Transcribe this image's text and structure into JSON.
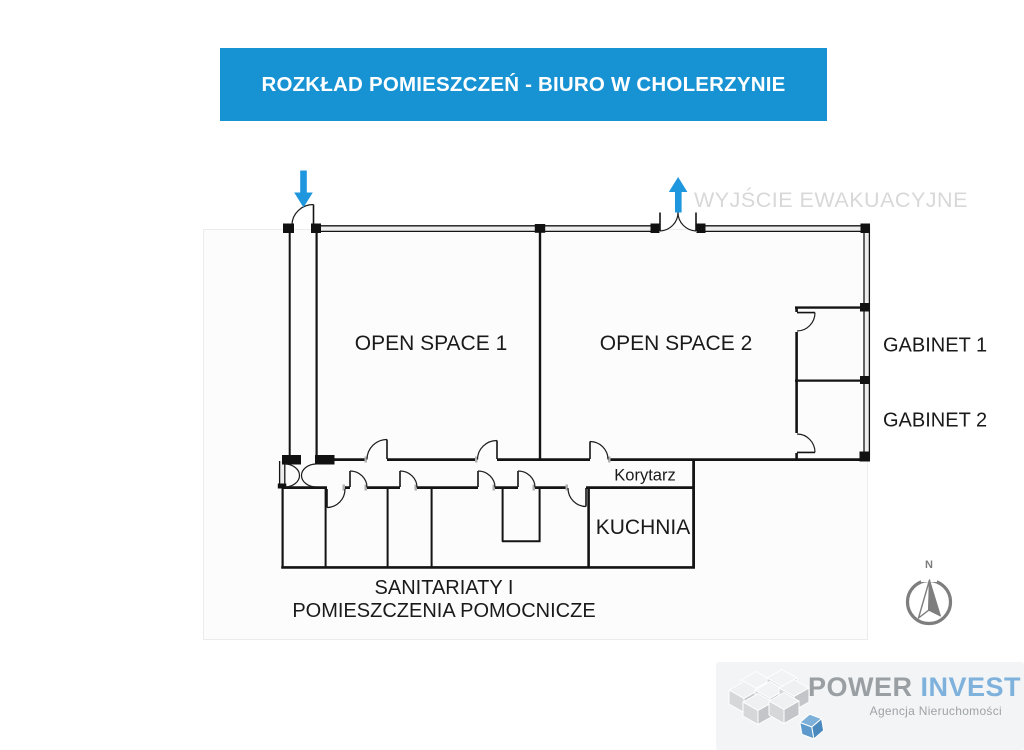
{
  "header": {
    "title": "ROZKŁAD POMIESZCZEŃ - BIURO W CHOLERZYNIE"
  },
  "plan": {
    "rooms": {
      "open_space_1": "OPEN SPACE 1",
      "open_space_2": "OPEN SPACE 2",
      "gabinet_1": "GABINET 1",
      "gabinet_2": "GABINET 2",
      "korytarz": "Korytarz",
      "kuchnia": "KUCHNIA",
      "sanitariaty_line1": "SANITARIATY I",
      "sanitariaty_line2": "POMIESZCZENIA POMOCNICZE"
    },
    "evac_label": "WYJŚCIE EWAKUACYJNE"
  },
  "compass": {
    "north_letter": "N"
  },
  "logo": {
    "brand_part1": "POWER",
    "brand_part2": "INVEST",
    "subtitle": "Agencja Nieruchomości"
  },
  "colors": {
    "banner_blue": "#1793d3",
    "arrow_blue": "#1e97de",
    "wall_black": "#141414",
    "evac_label_gray": "#d8d8d8",
    "compass_gray": "#7e7e7e",
    "logo_gray": "#9a9fa3",
    "logo_blue": "#7eb2dc"
  }
}
